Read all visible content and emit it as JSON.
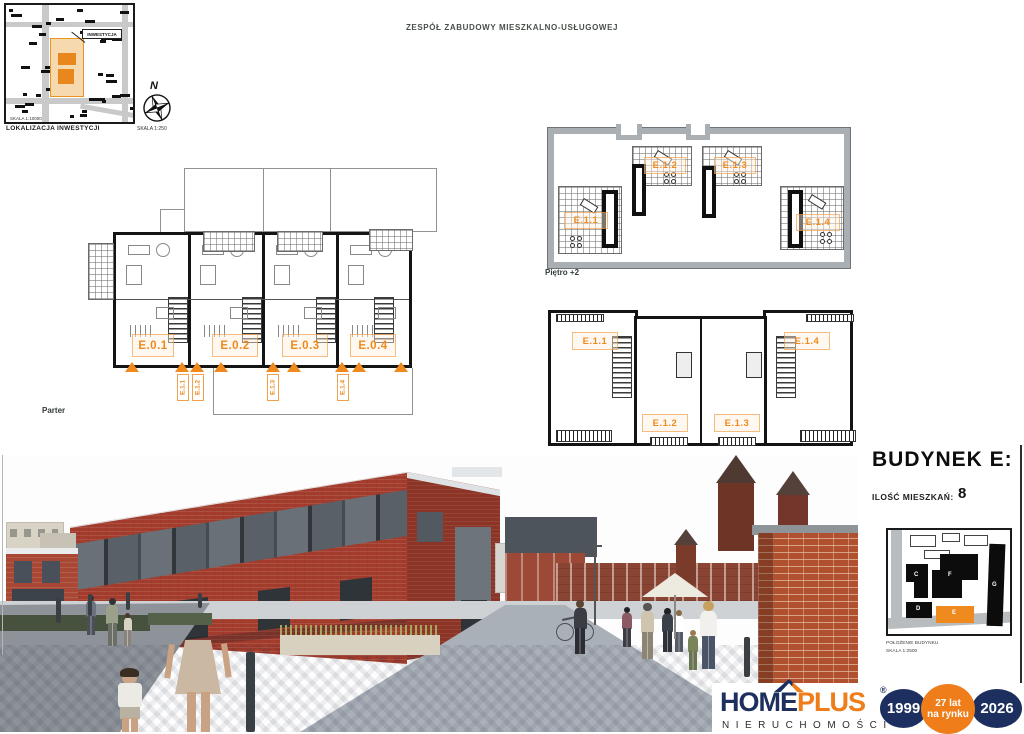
{
  "header": {
    "title": "ZESPÓŁ ZABUDOWY MIESZKALNO-USŁUGOWEJ"
  },
  "location_map": {
    "inwestycja_label": "INWESTYCJA",
    "inner_scale": "SKALA 1:10000",
    "caption": "LOKALIZACJA INWESTYCJI",
    "compass_letter": "N",
    "scale": "SKALA 1:250"
  },
  "plans": {
    "parter": {
      "label": "Parter",
      "units": [
        "E.0.1",
        "E.0.2",
        "E.0.3",
        "E.0.4"
      ],
      "entrances": [
        "E.1.1",
        "E.1.2",
        "E.1.3",
        "E.1.4"
      ]
    },
    "pietro1": {
      "label": "Piętro +1",
      "unit_top_left": "E.1.1",
      "unit_top_right": "E.1.4",
      "unit_bottom_left": "E.1.2",
      "unit_bottom_right": "E.1.3"
    },
    "pietro2": {
      "label": "Piętro +2",
      "unit_left": "E.1.1",
      "unit_top_left": "E.1.2",
      "unit_top_right": "E.1.3",
      "unit_right": "E.1.4"
    }
  },
  "building_panel": {
    "title": "BUDYNEK E:",
    "apartments_label": "ILOŚĆ MIESZKAŃ:",
    "apartments_count": "8",
    "site_map": {
      "building_c": "C",
      "building_f": "F",
      "building_d": "D",
      "building_e": "E",
      "building_g": "G",
      "caption_line1": "POŁOŻENIE BUDYNKU",
      "caption_line2": "SKALA 1:2500"
    }
  },
  "logo": {
    "name_part1": "HOME",
    "name_part2": "PLUS",
    "registered_mark": "®",
    "subtitle": "NIERUCHOMOŚCI",
    "year_start": "1999",
    "badge_line1": "27 lat",
    "badge_line2": "na rynku",
    "year_end": "2026"
  },
  "colors": {
    "accent_orange": "#EE8A1E",
    "brand_navy": "#1C2F5E"
  }
}
